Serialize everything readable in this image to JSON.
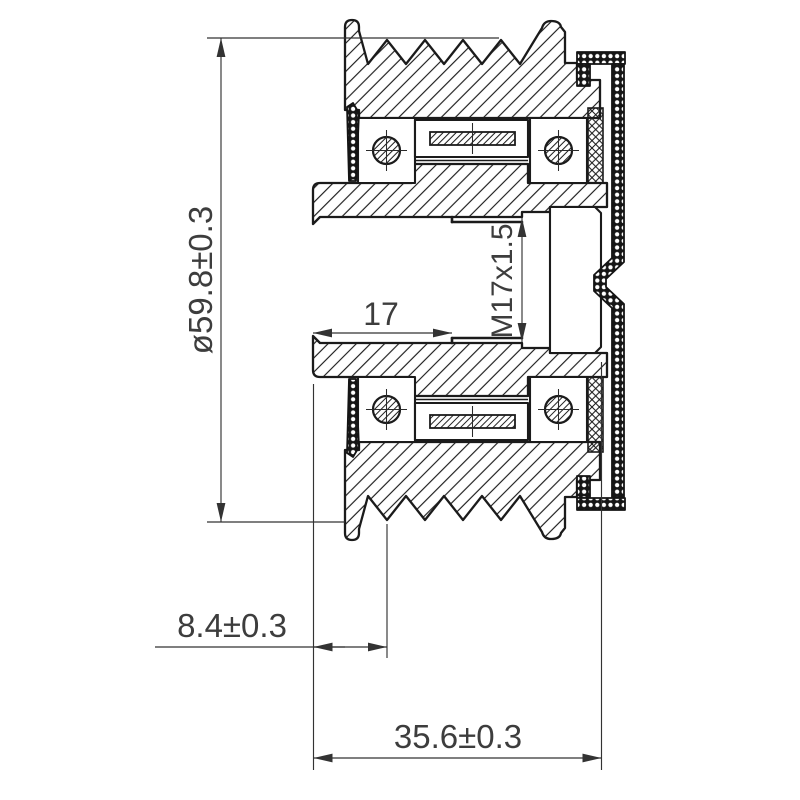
{
  "drawing": {
    "kind": "technical cross-section drawing",
    "labels": {
      "outer_diameter": "ø59.8±0.3",
      "bore_depth": "17",
      "thread": "M17x1.5",
      "face_to_first_groove": "8.4±0.3",
      "overall_width": "35.6±0.3"
    },
    "colors": {
      "background": "#ffffff",
      "line": "#1b1b1b",
      "dimension_line": "#333333",
      "text": "#3d3d3d"
    }
  }
}
